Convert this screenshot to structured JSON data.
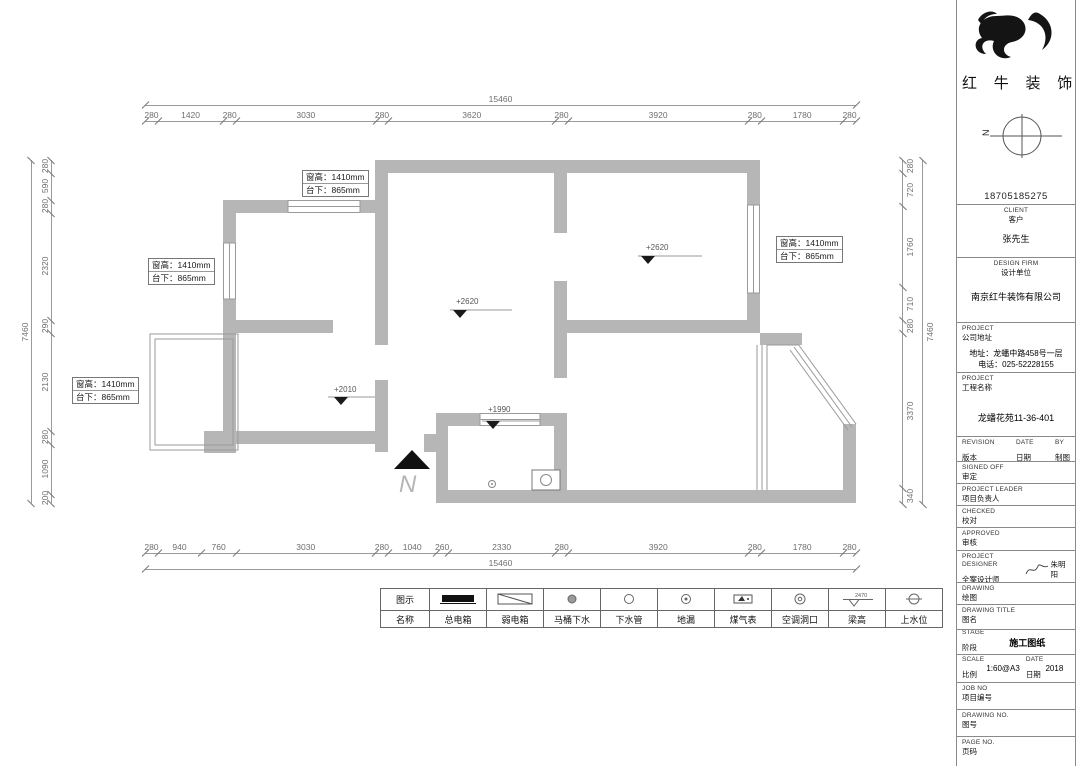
{
  "colors": {
    "wall": "#b6b6b6",
    "line": "#9a9a9a",
    "dim_text": "#6e6e6e"
  },
  "plan": {
    "dims": {
      "top": {
        "total": "15460",
        "segments": [
          "280",
          "1420",
          "280",
          "3030",
          "280",
          "3620",
          "280",
          "3920",
          "280",
          "1780",
          "280"
        ]
      },
      "bottom": {
        "total": "15460",
        "segments": [
          "280",
          "940",
          "760",
          "3030",
          "280",
          "1040",
          "260",
          "2330",
          "280",
          "3920",
          "280",
          "1780",
          "280"
        ]
      },
      "left": {
        "total": "7460",
        "segments": [
          "280",
          "590",
          "280",
          "2320",
          "290",
          "2130",
          "280",
          "1090",
          "200"
        ]
      },
      "right": {
        "total": "7460",
        "segments": [
          "280",
          "720",
          "1760",
          "710",
          "280",
          "3370",
          "340"
        ]
      }
    },
    "window_label": {
      "height": "窗高：1410mm",
      "sill": "台下：865mm"
    },
    "markers": {
      "m1": "+2620",
      "m2": "+2620",
      "m3": "+2010",
      "m4": "+1990"
    },
    "north": "N"
  },
  "legend": {
    "row1_header": "图示",
    "row2_header": "名称",
    "beam_value": "2470",
    "items": [
      {
        "name": "总电箱",
        "icon": "main-electric-box"
      },
      {
        "name": "弱电箱",
        "icon": "weak-electric-box"
      },
      {
        "name": "马桶下水",
        "icon": "toilet-drain"
      },
      {
        "name": "下水管",
        "icon": "drain-pipe"
      },
      {
        "name": "地漏",
        "icon": "floor-drain"
      },
      {
        "name": "煤气表",
        "icon": "gas-meter"
      },
      {
        "name": "空调洞口",
        "icon": "ac-opening"
      },
      {
        "name": "梁高",
        "icon": "beam-height"
      },
      {
        "name": "上水位",
        "icon": "water-supply-point"
      }
    ]
  },
  "titleblock": {
    "brand": "红 牛 装 饰",
    "compass_n": "N",
    "phone": "18705185275",
    "client_en": "CLIENT",
    "client_zh": "客户",
    "client_value": "张先生",
    "firm_en": "DESIGN FIRM",
    "firm_zh": "设计单位",
    "firm_value": "南京红牛装饰有限公司",
    "addr_en": "PROJECT",
    "addr_zh": "公司地址",
    "addr_line1": "地址：龙蟠中路458号一层",
    "addr_line2": "电话：025-52228155",
    "proj_en": "PROJECT",
    "proj_zh": "工程名称",
    "proj_value": "龙蟠花苑11-36-401",
    "revision_en": "REVISION",
    "revision_zh": "版本",
    "date_en": "DATE",
    "date_zh": "日期",
    "by_en": "BY",
    "by_zh": "制图",
    "signed_en": "SIGNED OFF",
    "signed_zh": "审定",
    "leader_en": "PROJECT LEADER",
    "leader_zh": "项目负责人",
    "checked_en": "CHECKED",
    "checked_zh": "校对",
    "approved_en": "APPROVED",
    "approved_zh": "审核",
    "designer_en": "PROJECT DESIGNER",
    "designer_zh": "全案设计师",
    "designer_name": "朱明阳",
    "drawing_en": "DRAWING",
    "drawing_zh": "绘图",
    "dwgtitle_en": "DRAWING TITLE",
    "dwgtitle_zh": "图名",
    "stage_en": "STAGE",
    "stage_zh": "阶段",
    "stage_value": "施工图纸",
    "scale_en": "SCALE",
    "scale_zh": "比例",
    "scale_value": "1:60@A3",
    "date2_en": "DATE",
    "date2_zh": "日期",
    "date_value": "2018",
    "job_en": "JOB NO",
    "job_zh": "项目编号",
    "dwgno_en": "DRAWING NO.",
    "dwgno_zh": "图号",
    "page_en": "PAGE NO.",
    "page_zh": "页码"
  }
}
